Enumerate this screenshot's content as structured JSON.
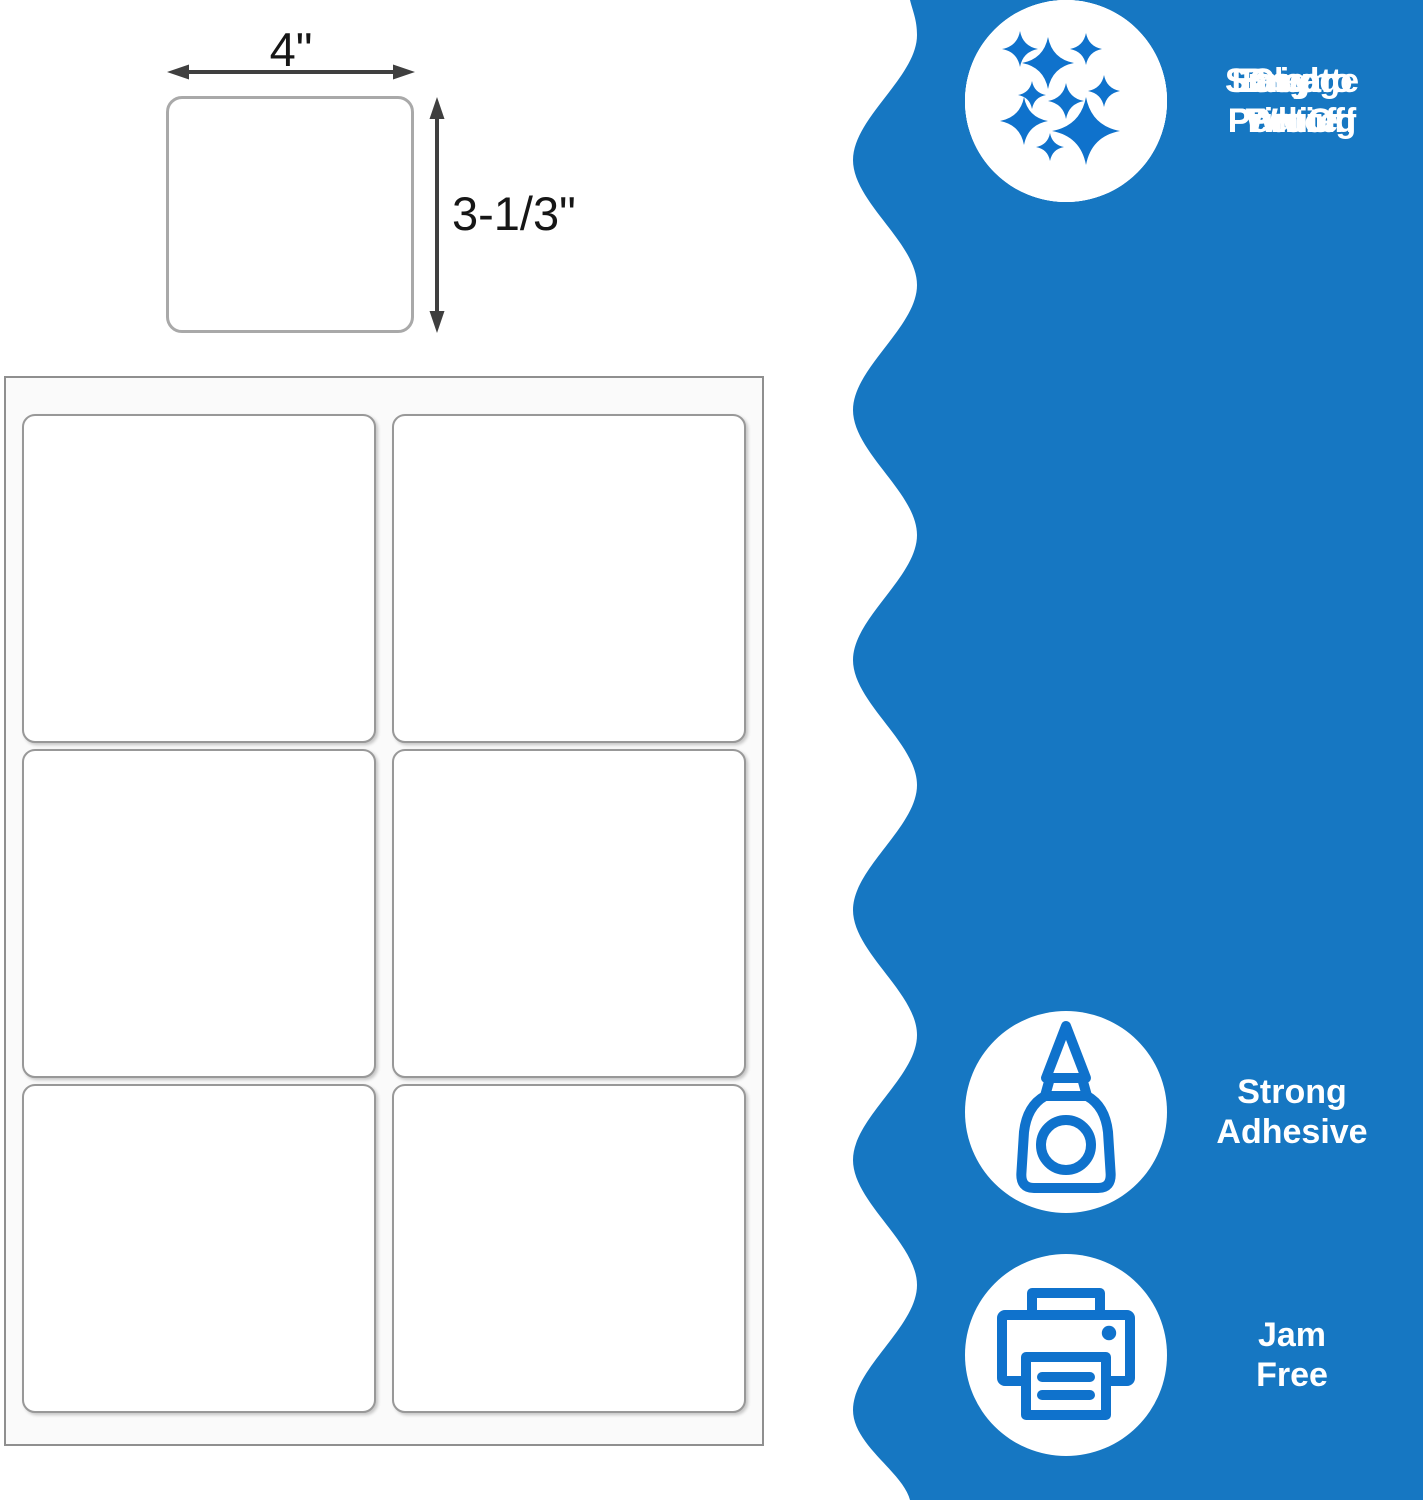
{
  "label_diagram": {
    "width_label": "4\"",
    "height_label": "3-1/3\"",
    "arrow_color": "#3f3f3f",
    "box_border_color": "#a9a9a9"
  },
  "label_sheet": {
    "columns": 2,
    "rows": 3,
    "labels_count": 6,
    "sheet_background": "#fafafa",
    "border_color": "#8f8f8f"
  },
  "features_panel": {
    "band_color": "#1677c2",
    "icon_color": "#0f72cc",
    "text_color": "#ffffff",
    "items": [
      {
        "icon": "glue-bottle-icon",
        "lines": [
          "Strong",
          "Adhesive"
        ]
      },
      {
        "icon": "printer-icon",
        "lines": [
          "Jam",
          "Free"
        ]
      },
      {
        "icon": "peel-sticker-icon",
        "lines": [
          "Easy to",
          "Peel Off"
        ]
      },
      {
        "icon": "hand-wipe-icon",
        "lines": [
          "Smudge",
          "Proof"
        ]
      },
      {
        "icon": "documents-icon",
        "lines": [
          "Clear",
          "Printing"
        ]
      },
      {
        "icon": "sparkles-icon",
        "lines": [
          "Bright",
          "White"
        ]
      }
    ]
  }
}
